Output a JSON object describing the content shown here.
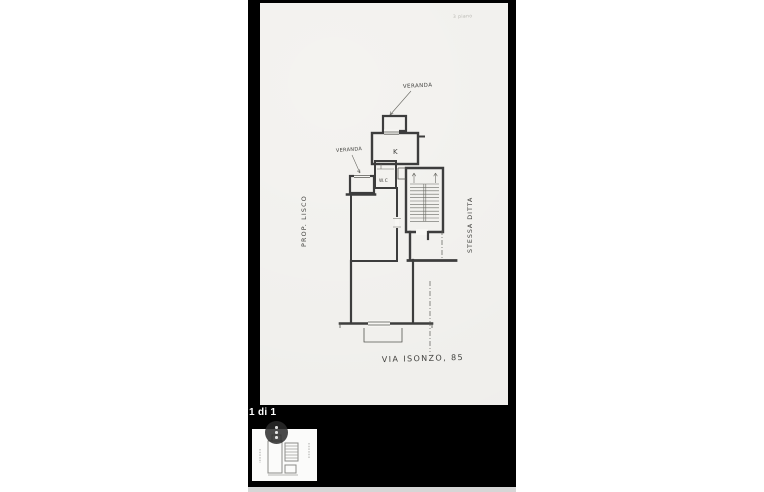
{
  "viewer": {
    "page_indicator": "1 di 1",
    "colors": {
      "background": "#000000",
      "paper": "#f7f6f3",
      "ink": "#3d3d3d",
      "scrollbar": "#d6d6d6",
      "overlay_circle": "rgba(42,42,42,0.85)"
    }
  },
  "plan": {
    "scale_note": "3 piano",
    "labels": {
      "veranda_top": "VERANDA",
      "veranda_left": "VERANDA",
      "kitchen": "K",
      "wc": "W.C",
      "owner_left": "PROP. LISCO",
      "firm_right": "STESSA DITTA",
      "address": "VIA ISONZO, 85"
    }
  }
}
